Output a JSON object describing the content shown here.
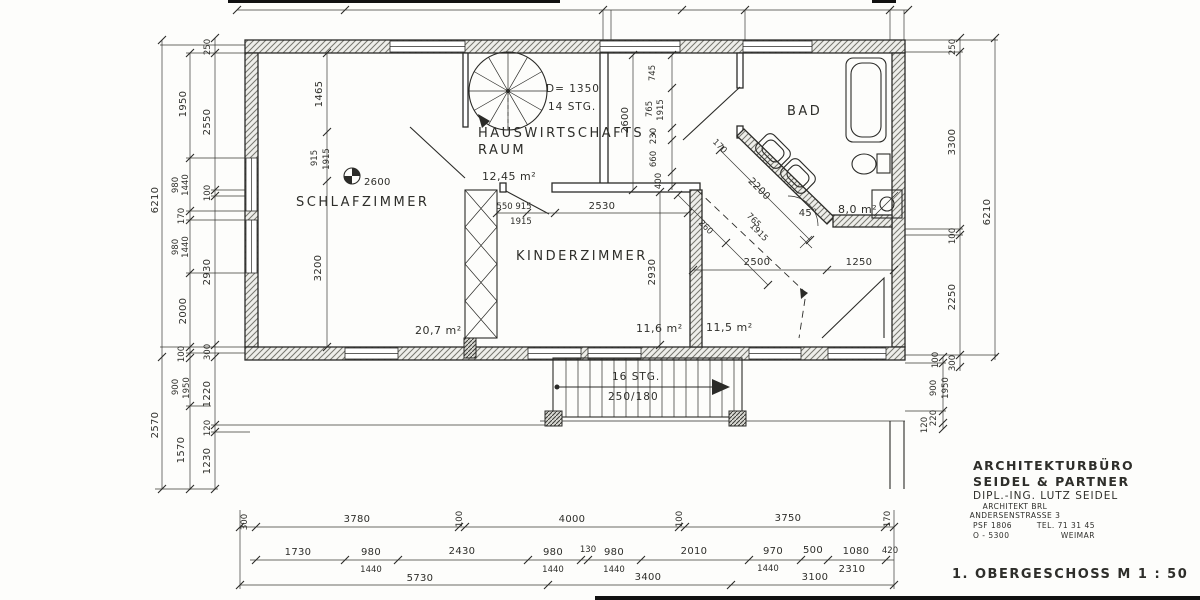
{
  "title_block": {
    "office_line1": "ARCHITEKTURBÜRO",
    "office_line2": "SEIDEL & PARTNER",
    "office_line3": "DIPL.-ING. LUTZ SEIDEL",
    "office_line4": "ARCHITEKT BRL",
    "office_line5": "ANDERSENSTRASSE 3",
    "pobox": "PSF 1806",
    "phone": "TEL. 71 31 45",
    "postcode": "O - 5300",
    "city": "WEIMAR",
    "drawing_title": "1. OBERGESCHOSS  M 1 : 50"
  },
  "rooms": {
    "schlafzimmer": {
      "label": "SCHLAFZIMMER",
      "area": "20,7 m²"
    },
    "hwr": {
      "label1": "HAUSWIRTSCHAFTS -",
      "label2": "RAUM",
      "area": "12,45 m²"
    },
    "kinderzimmer": {
      "label": "KINDERZIMMER",
      "area": "11,6 m²"
    },
    "flur": {
      "area": "11,5 m²"
    },
    "bad": {
      "label": "BAD",
      "area": "8,0 m²"
    }
  },
  "stairs": {
    "spiral": {
      "diameter": "D= 1350",
      "steps": "14 STG."
    },
    "main": {
      "steps": "16 STG.",
      "tread": "250/180"
    }
  },
  "symbols": {
    "level_value": "2600",
    "angle_label": "45°"
  },
  "dims": {
    "left_outer": [
      "6210",
      "2570"
    ],
    "left_mid": [
      "1950",
      "980",
      "1440",
      "170",
      "980",
      "1440",
      "2000",
      "100",
      "900",
      "1950",
      "1570"
    ],
    "left_inner": [
      "250",
      "2550",
      "100",
      "2930",
      "300",
      "1220",
      "120",
      "1230"
    ],
    "right_inner": [
      "250",
      "3300",
      "100",
      "2250",
      "300"
    ],
    "right_lower": [
      "100",
      "900",
      "1950",
      "220",
      "120"
    ],
    "right_outer": "6210",
    "bottom_row1": [
      "300",
      "3780",
      "100",
      "4000",
      "100",
      "3750",
      "170"
    ],
    "bottom_row2": [
      "1730",
      "980",
      "2430",
      "980",
      "130",
      "980",
      "2010",
      "970",
      "500",
      "1080",
      "420"
    ],
    "bottom_row2_sub": [
      "1440",
      "1440",
      "1440",
      "1440",
      "2310"
    ],
    "bottom_row3": [
      "5730",
      "3400",
      "3100"
    ],
    "schlaf_chain": [
      "1465",
      "915",
      "1915",
      "3200"
    ],
    "corridor": [
      "2600",
      "745",
      "765",
      "1915",
      "230",
      "660",
      "400"
    ],
    "kinder": [
      "2530",
      "2930"
    ],
    "kinder_door": [
      "550 915",
      "1915"
    ],
    "hall": [
      "2500",
      "1250"
    ],
    "bad_diag": [
      "2200",
      "170",
      "260",
      "765",
      "1915"
    ]
  }
}
